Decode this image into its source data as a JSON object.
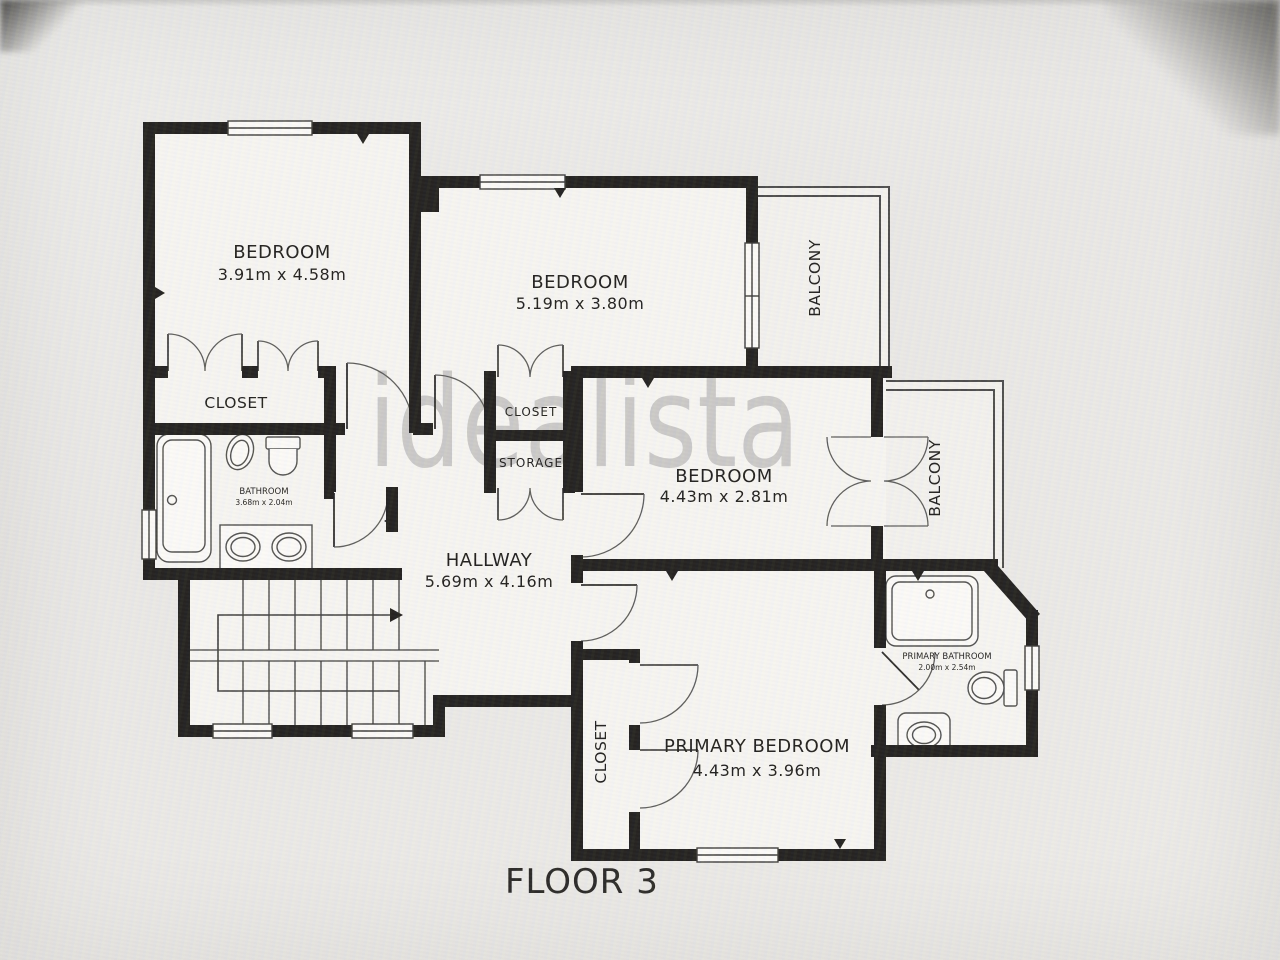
{
  "watermark": "idealista",
  "floor_title": "FLOOR 3",
  "rooms": {
    "bedroom1": {
      "name": "BEDROOM",
      "dims": "3.91m x 4.58m"
    },
    "bedroom2": {
      "name": "BEDROOM",
      "dims": "5.19m x 3.80m"
    },
    "bedroom3": {
      "name": "BEDROOM",
      "dims": "4.43m x 2.81m"
    },
    "primary_bedroom": {
      "name": "PRIMARY BEDROOM",
      "dims": "4.43m x 3.96m"
    },
    "hallway": {
      "name": "HALLWAY",
      "dims": "5.69m x 4.16m"
    },
    "bathroom": {
      "name": "BATHROOM",
      "dims": "3.68m x 2.04m"
    },
    "primary_bathroom": {
      "name": "PRIMARY BATHROOM",
      "dims": "2.00m x 2.54m"
    },
    "closet_bedroom1": {
      "name": "CLOSET"
    },
    "closet_hall": {
      "name": "CLOSET"
    },
    "storage": {
      "name": "STORAGE"
    },
    "closet_primary": {
      "name": "CLOSET"
    },
    "balcony_top": {
      "name": "BALCONY"
    },
    "balcony_right": {
      "name": "BALCONY"
    }
  },
  "colors": {
    "wall": "#1f1e1c",
    "floor": "#f6f5f2",
    "thin_line": "#4a4a4a",
    "watermark": "#8f8f8f"
  }
}
